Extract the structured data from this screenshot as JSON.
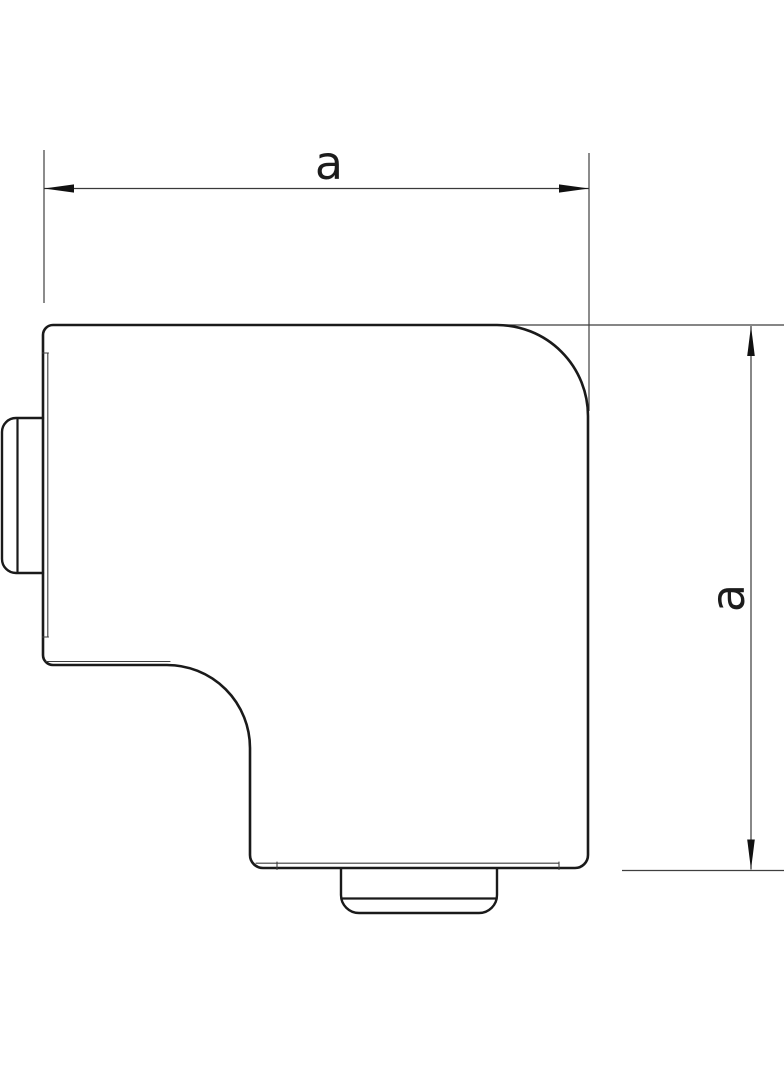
{
  "drawing": {
    "kind": "technical dimension drawing",
    "subject": "flat-angle corner cover (L-shaped trunking piece), top view",
    "dimensions": {
      "horizontal": "a",
      "vertical": "a"
    },
    "colors": {
      "background": "#ffffff",
      "outline": "#1a1a1a",
      "thin_line": "#3f3f3f",
      "dimension_line": "#3a3a3a"
    }
  }
}
